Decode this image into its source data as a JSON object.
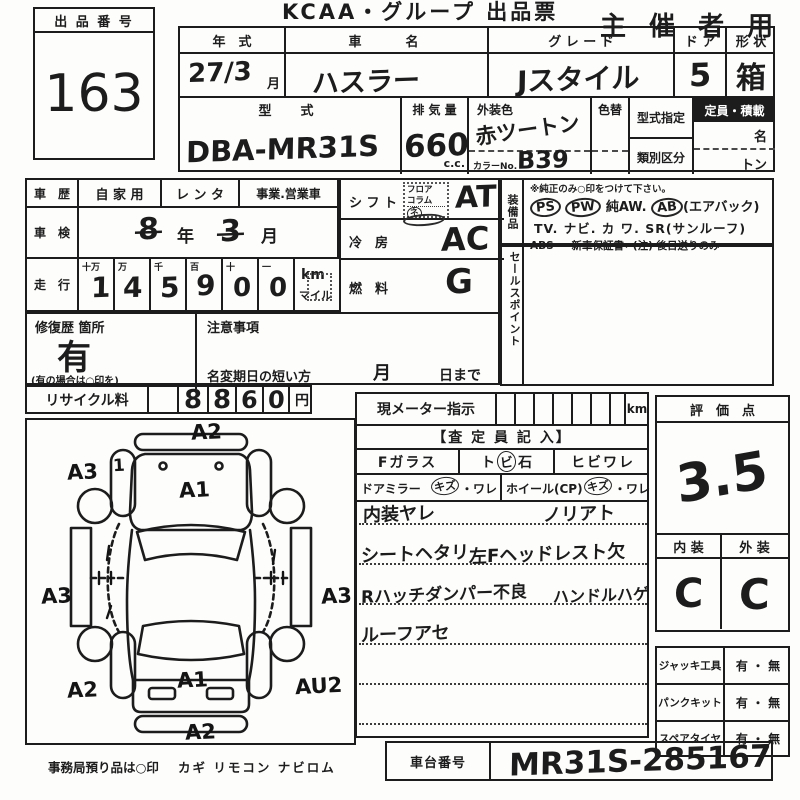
{
  "header": {
    "lot_label": "出 品 番 号",
    "lot_number": "163",
    "title": "KCAA・グループ 出品票",
    "audience": "主 催 者 用"
  },
  "spec": {
    "year_label": "年　式",
    "year_value": "27/3",
    "year_unit": "月",
    "name_label": "車　　名",
    "name_value": "ハスラー",
    "grade_label": "グ レ ー ド",
    "grade_value": "Jスタイル",
    "door_label": "ド ア",
    "door_value": "5",
    "shape_label": "形 状",
    "shape_value": "箱",
    "model_label": "型　式",
    "model_value": "DBA-MR31S",
    "disp_label": "排 気 量",
    "disp_value": "660",
    "disp_unit": "c.c.",
    "color_label": "外装色",
    "color_value": "赤ツートン",
    "color_no_label": "カラーNo.",
    "color_no_value": "B39",
    "repaint_label": "色替",
    "type_desig_label": "型式指定",
    "class_label": "類別区分",
    "capacity_label": "定員・積載",
    "capacity_unit1": "名",
    "capacity_unit2": "トン"
  },
  "history": {
    "career_label": "車　歴",
    "private": "自 家 用",
    "rental": "レ ン タ",
    "business": "事業.営業車",
    "shaken_label": "車　検",
    "shaken_year": "8",
    "shaken_year_unit": "年",
    "shaken_month": "3",
    "shaken_month_unit": "月",
    "mileage_label": "走　行",
    "digit_headers": [
      "十万",
      "万",
      "千",
      "百",
      "十",
      "一"
    ],
    "digits": [
      "1",
      "4",
      "5",
      "9",
      "0",
      "0"
    ],
    "km": "km",
    "mile": "マイル",
    "repair_label": "修復歴 箇所",
    "repair_value": "有",
    "repair_note": "(有の場合は○印を)",
    "caution_label": "注意事項",
    "rename_label": "名変期日の短い方",
    "rename_month": "月",
    "rename_day": "日まで",
    "recycle_label": "リサイクル料",
    "recycle_digits": [
      "8",
      "8",
      "6",
      "0"
    ],
    "recycle_unit": "円"
  },
  "shift": {
    "label": "シ フ ト",
    "opt1": "フロア",
    "opt2": "コラム",
    "opt3": "ネ",
    "value": "AT"
  },
  "ac": {
    "label": "冷　房",
    "value": "AC"
  },
  "fuel": {
    "label": "燃　料",
    "value": "G"
  },
  "equipment": {
    "label": "装備品",
    "note": "※純正のみ○印をつけて下さい。",
    "ps": "PS",
    "pw": "PW",
    "aw": "純AW.",
    "ab": "AB",
    "ab_suffix": "(エアバック)",
    "line2": "TV. ナビ. カ ワ. SR(サンルーフ)",
    "line3": "ABS ・ 新車保証書←(注) 後日送りのみ"
  },
  "sales_point": {
    "label": "セールスポイント"
  },
  "meter": {
    "label": "現メーター指示",
    "unit": "km"
  },
  "inspector": {
    "header": "【査 定 員 記 入】",
    "glass_label": "Fガラス",
    "glass_opt1": "ト",
    "glass_opt2": "ビ",
    "glass_opt3": "石",
    "glass_opt4": "ヒビワレ",
    "mirror_label": "ドアミラー",
    "mirror_circle": "キズ",
    "mirror_rest": "・ワレ",
    "wheel_label": "ホイール(CP)",
    "wheel_circle": "キズ",
    "wheel_rest": "・ワレ",
    "note1a": "内装ヤレ",
    "note1b": "ノリアト",
    "note2a": "シートヘタリ",
    "note2b": "左Fヘッドレスト欠",
    "note3a": "Rハッチダンパー不良",
    "note3b": "ハンドルハゲ",
    "note4a": "ルーフアセ"
  },
  "evaluation": {
    "label": "評　価　点",
    "score": "3.5",
    "interior_label": "内 装",
    "exterior_label": "外 装",
    "interior_grade": "C",
    "exterior_grade": "C"
  },
  "tools": {
    "rows": [
      {
        "label": "ジャッキ工具",
        "value": "有 ・ 無"
      },
      {
        "label": "パンクキット",
        "value": "有 ・ 無"
      },
      {
        "label": "スペアタイヤ",
        "value": "有 ・ 無"
      }
    ]
  },
  "chassis": {
    "label": "車台番号",
    "value": "MR31S-285167"
  },
  "footer": {
    "note": "事務局預り品は○印",
    "items": "カギ  リモコン  ナビロム"
  },
  "diagram": {
    "front": "A2",
    "front_left": "A3",
    "front_left_tick": "1",
    "hood": "A1",
    "left": "A3",
    "right": "A3",
    "rear_left": "A2",
    "rear_right": "AU2",
    "rear": "A1",
    "bottom": "A2"
  }
}
